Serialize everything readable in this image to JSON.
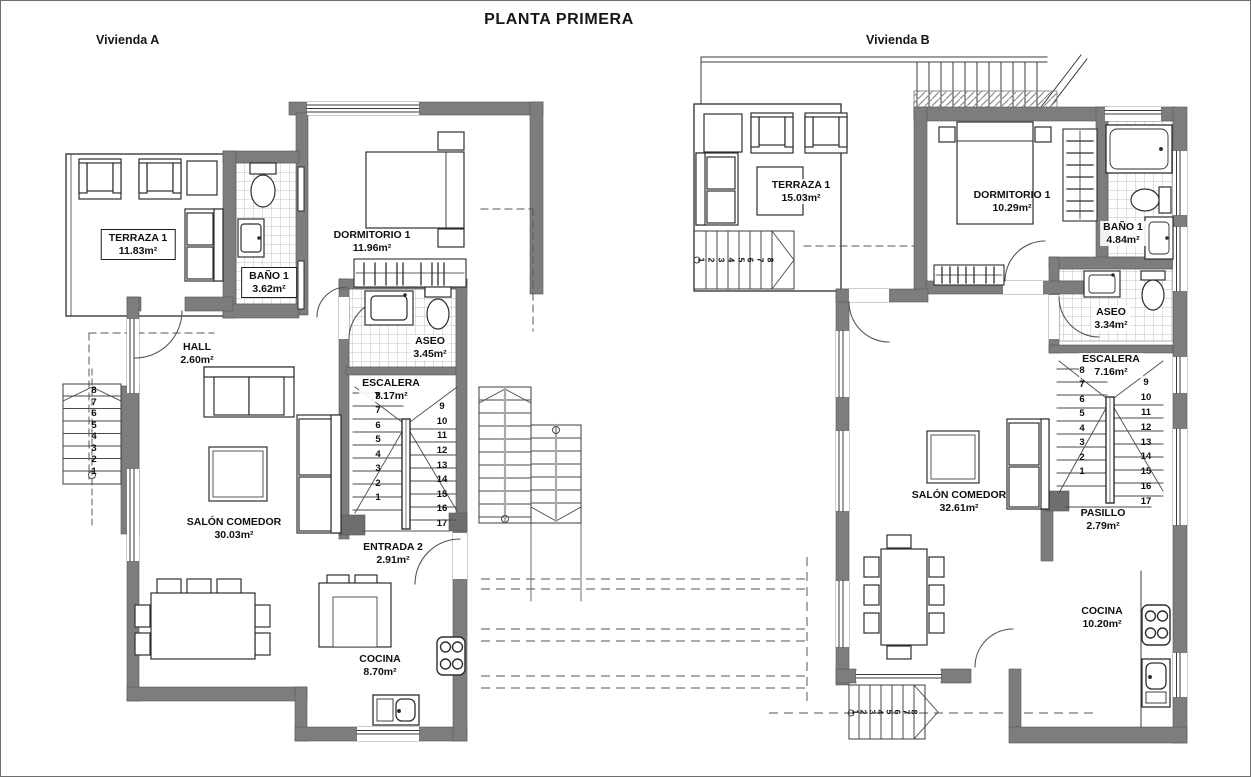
{
  "title": "PLANTA PRIMERA",
  "unit_a": {
    "label": "Vivienda A",
    "rooms": {
      "terraza": {
        "name": "TERRAZA 1",
        "area": "11.83m²"
      },
      "bano": {
        "name": "BAÑO 1",
        "area": "3.62m²"
      },
      "dormitorio": {
        "name": "DORMITORIO 1",
        "area": "11.96m²"
      },
      "hall": {
        "name": "HALL",
        "area": "2.60m²"
      },
      "aseo": {
        "name": "ASEO",
        "area": "3.45m²"
      },
      "escalera": {
        "name": "ESCALERA",
        "area": "7.17m²"
      },
      "salon": {
        "name": "SALÓN COMEDOR",
        "area": "30.03m²"
      },
      "entrada": {
        "name": "ENTRADA 2",
        "area": "2.91m²"
      },
      "cocina": {
        "name": "COCINA",
        "area": "8.70m²"
      }
    },
    "stairs": {
      "interior_left": [
        "1",
        "2",
        "3",
        "4",
        "5",
        "6",
        "7",
        "8"
      ],
      "interior_right": [
        "9",
        "10",
        "11",
        "12",
        "13",
        "14",
        "15",
        "16",
        "17"
      ],
      "exterior_left": [
        "1",
        "2",
        "3",
        "4",
        "5",
        "6",
        "7",
        "8"
      ]
    }
  },
  "unit_b": {
    "label": "Vivienda B",
    "rooms": {
      "terraza": {
        "name": "TERRAZA 1",
        "area": "15.03m²"
      },
      "dormitorio": {
        "name": "DORMITORIO 1",
        "area": "10.29m²"
      },
      "bano": {
        "name": "BAÑO 1",
        "area": "4.84m²"
      },
      "aseo": {
        "name": "ASEO",
        "area": "3.34m²"
      },
      "escalera": {
        "name": "ESCALERA",
        "area": "7.16m²"
      },
      "salon": {
        "name": "SALÓN COMEDOR",
        "area": "32.61m²"
      },
      "pasillo": {
        "name": "PASILLO",
        "area": "2.79m²"
      },
      "cocina": {
        "name": "COCINA",
        "area": "10.20m²"
      }
    },
    "stairs": {
      "interior_left": [
        "1",
        "2",
        "3",
        "4",
        "5",
        "6",
        "7",
        "8"
      ],
      "interior_right": [
        "9",
        "10",
        "11",
        "12",
        "13",
        "14",
        "15",
        "16",
        "17"
      ],
      "terrace": [
        "1",
        "2",
        "3",
        "4",
        "5",
        "6",
        "7",
        "8"
      ],
      "bottom": [
        "1",
        "2",
        "3",
        "4",
        "5",
        "6",
        "7",
        "8"
      ]
    }
  },
  "colors": {
    "wall": "#7d7d7d",
    "line": "#3b3b3b",
    "tile_line": "#c2c2c2",
    "dash_line": "#555555"
  }
}
